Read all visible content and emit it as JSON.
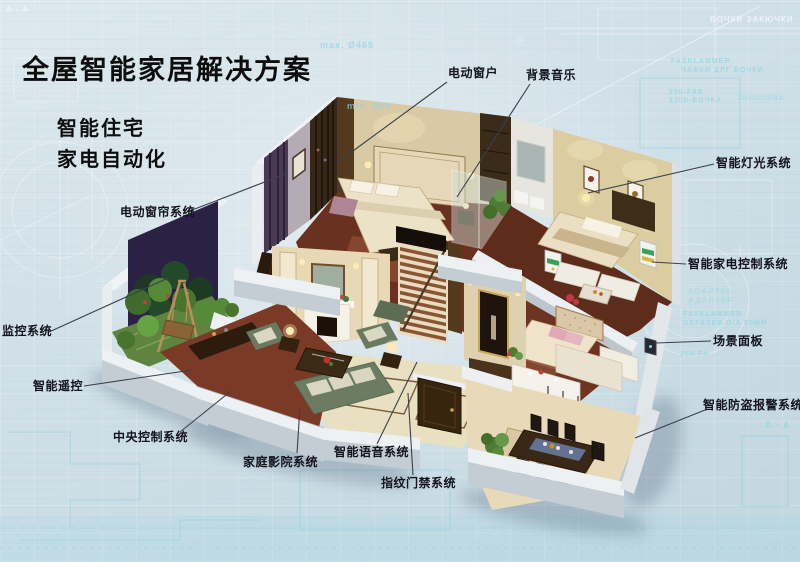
{
  "title": "全屋智能家居解决方案",
  "subtitle_lines": [
    "智能住宅",
    "家电自动化"
  ],
  "labels": [
    {
      "id": "electric-window",
      "text": "电动窗户",
      "tx": 448,
      "ty": 66,
      "line": [
        447,
        82,
        338,
        162
      ]
    },
    {
      "id": "background-music",
      "text": "背景音乐",
      "tx": 526,
      "ty": 68,
      "line": [
        530,
        84,
        457,
        197
      ]
    },
    {
      "id": "smart-lighting",
      "text": "智能灯光系统",
      "tx": 716,
      "ty": 156,
      "line": [
        714,
        164,
        588,
        193
      ]
    },
    {
      "id": "smart-appliance-control",
      "text": "智能家电控制系统",
      "tx": 688,
      "ty": 257,
      "line": [
        686,
        264,
        652,
        262
      ]
    },
    {
      "id": "scene-panel",
      "text": "场景面板",
      "tx": 713,
      "ty": 334,
      "line": [
        711,
        341,
        656,
        343
      ]
    },
    {
      "id": "burglar-alarm",
      "text": "智能防盗报警系统",
      "tx": 703,
      "ty": 398,
      "line": [
        705,
        410,
        635,
        438
      ]
    },
    {
      "id": "electric-curtain",
      "text": "电动窗帘系统",
      "tx": 120,
      "ty": 205,
      "line": [
        187,
        212,
        288,
        173
      ]
    },
    {
      "id": "monitoring-system",
      "text": "监控系统",
      "tx": 2,
      "ty": 324,
      "line": [
        49,
        332,
        168,
        278
      ]
    },
    {
      "id": "smart-remote",
      "text": "智能遥控",
      "tx": 33,
      "ty": 379,
      "line": [
        84,
        386,
        192,
        370
      ]
    },
    {
      "id": "central-control",
      "text": "中央控制系统",
      "tx": 113,
      "ty": 430,
      "line": [
        180,
        432,
        231,
        391
      ]
    },
    {
      "id": "home-theater",
      "text": "家庭影院系统",
      "tx": 243,
      "ty": 455,
      "line": [
        297,
        453,
        300,
        407
      ]
    },
    {
      "id": "voice-system",
      "text": "智能语音系统",
      "tx": 334,
      "ty": 445,
      "line": [
        377,
        444,
        417,
        362
      ]
    },
    {
      "id": "fingerprint-access",
      "text": "指纹门禁系统",
      "tx": 381,
      "ty": 476,
      "line": [
        413,
        475,
        408,
        393
      ]
    }
  ],
  "background_words": [
    {
      "text": "A - A",
      "x": 6,
      "y": 5,
      "s": 8,
      "c": "#ffffff",
      "o": 0.55
    },
    {
      "text": "max. Ø465",
      "x": 320,
      "y": 40,
      "s": 9,
      "c": "#8fd8e2",
      "o": 0.75
    },
    {
      "text": "min. 820",
      "x": 347,
      "y": 101,
      "s": 9,
      "c": "#8fd8e2",
      "o": 0.7
    },
    {
      "text": "БОЧКИ ЗАКЮЧКИ",
      "x": 710,
      "y": 15,
      "s": 8,
      "c": "#ffffff",
      "o": 0.6
    },
    {
      "text": "FASKLAMMER",
      "x": 671,
      "y": 58,
      "s": 7,
      "c": "#8fd8e2",
      "o": 0.8
    },
    {
      "text": "ЧАФКИ ДЛГ БОЧКИ",
      "x": 681,
      "y": 67,
      "s": 7,
      "c": "#8fd8e2",
      "o": 0.75
    },
    {
      "text": "200-FAB",
      "x": 669,
      "y": 89,
      "s": 7,
      "c": "#8fd8e2",
      "o": 0.75
    },
    {
      "text": "2J0h-БОЧКА",
      "x": 669,
      "y": 97,
      "s": 7,
      "c": "#8fd8e2",
      "o": 0.75
    },
    {
      "text": "JUHGOSNA",
      "x": 737,
      "y": 95,
      "s": 7,
      "c": "#8fd8e2",
      "o": 0.6
    },
    {
      "text": "ADAPTEL",
      "x": 688,
      "y": 287,
      "s": 8,
      "c": "#9fdce6",
      "o": 0.7
    },
    {
      "text": "АДАПТЕР",
      "x": 688,
      "y": 296,
      "s": 8,
      "c": "#9fdce6",
      "o": 0.7
    },
    {
      "text": "FASKLAMMER",
      "x": 683,
      "y": 311,
      "s": 7,
      "c": "#8fd8e2",
      "o": 0.8
    },
    {
      "text": "GEFASEB DIA 50MM",
      "x": 683,
      "y": 320,
      "s": 7,
      "c": "#8fd8e2",
      "o": 0.75
    },
    {
      "text": "200-FA",
      "x": 680,
      "y": 351,
      "s": 7,
      "c": "#8fd8e2",
      "o": 0.7
    },
    {
      "text": "A - A",
      "x": 765,
      "y": 420,
      "s": 9,
      "c": "#8fd8e2",
      "o": 0.8
    }
  ],
  "colors": {
    "background": "#cfdfe7",
    "blueprint_line": "#8fd8e2",
    "label_text": "#14141e",
    "callout_line": "#39404e",
    "title_text": "#0d0d0d"
  }
}
